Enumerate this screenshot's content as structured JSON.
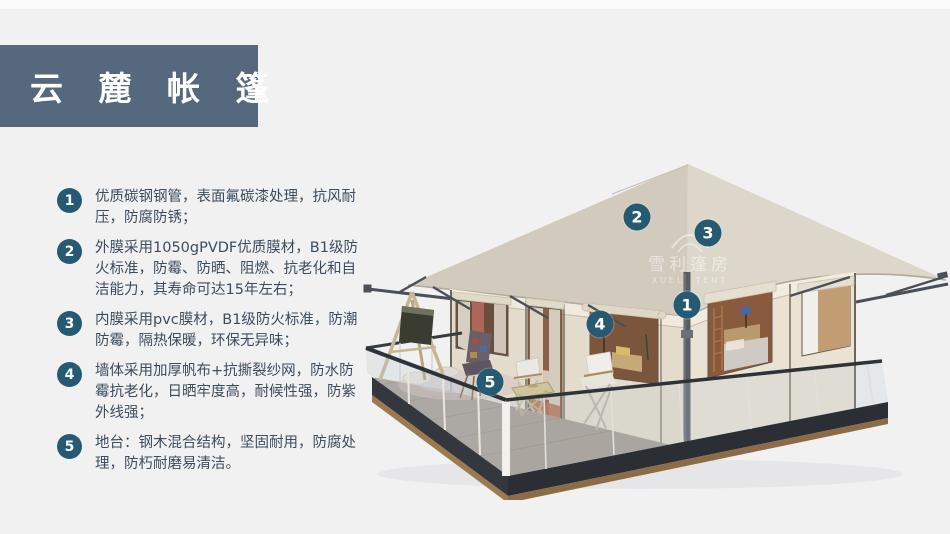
{
  "header": {
    "title": "云 麓 帐 篷"
  },
  "features": [
    {
      "num": "1",
      "text": "优质碳钢钢管，表面氟碳漆处理，抗风耐压，防腐防锈；"
    },
    {
      "num": "2",
      "text": "外膜采用1050gPVDF优质膜材，B1级防火标准，防霉、防晒、阻燃、抗老化和自洁能力，其寿命可达15年左右；"
    },
    {
      "num": "3",
      "text": "内膜采用pvc膜材，B1级防火标准，防潮防霉，隔热保暖，环保无异味；"
    },
    {
      "num": "4",
      "text": "墙体采用加厚帆布+抗撕裂纱网，防水防霉抗老化，日晒牢度高，耐候性强，防紫外线强；"
    },
    {
      "num": "5",
      "text": "地台：钢木混合结构，坚固耐用，防腐处理，防朽耐磨易清洁。"
    }
  ],
  "markers": [
    "1",
    "2",
    "3",
    "4",
    "5"
  ],
  "watermark": {
    "cn": "雪利篷房",
    "en": "XUELI TENT"
  },
  "colors": {
    "page_bg": "#f1f1f2",
    "banner_bg": "#55687d",
    "badge": "#255a72",
    "body_text": "#3c4c5f",
    "roof": "#d6cfc3",
    "wall": "#e6dfd0"
  }
}
